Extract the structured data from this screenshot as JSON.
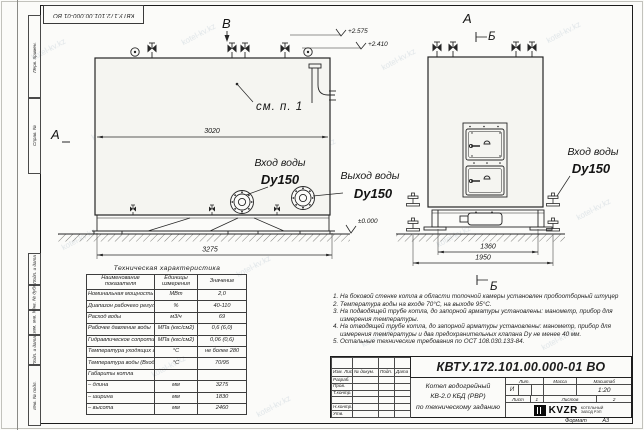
{
  "sheet": {
    "doc_number": "КВТУ.172.101.00.000-01 ВО"
  },
  "frame_fields": [
    "Перв. примен.",
    "Справ. №",
    "Подп. и дата",
    "Инв. № дубл.",
    "Взам. инв. №",
    "Подп. и дата",
    "Инв. № подл."
  ],
  "watermark": "kotel-kv.kz",
  "drawing": {
    "markers": {
      "view_b": "В",
      "section_a_left": "А",
      "section_a_right": "А",
      "section_b_top": "Б",
      "section_b_bottom": "Б"
    },
    "elevations": {
      "top_valve": "+2.575",
      "top_body": "+2.410",
      "ground": "±0.000"
    },
    "dimensions": {
      "body_length": "3020",
      "overall_length": "3275",
      "base_width": "1360",
      "overall_width": "1950"
    },
    "callout": "см. п. 1",
    "nozzles": {
      "inlet_side": {
        "line1": "Вход воды",
        "line2": "Dy150"
      },
      "outlet_side": {
        "line1": "Выход воды",
        "line2": "Dy150"
      },
      "inlet_front": {
        "line1": "Вход воды",
        "line2": "Dy150"
      }
    }
  },
  "spec_table": {
    "title": "Техническая характеристика",
    "headers": [
      "Наименование показателя",
      "Единицы измерения",
      "Значение"
    ],
    "rows": [
      [
        "Номинальная мощность",
        "МВт",
        "2,0"
      ],
      [
        "Диапазон рабочего регулирования",
        "%",
        "40-110"
      ],
      [
        "Расход воды",
        "м3/ч",
        "69"
      ],
      [
        "Рабочее давление воды",
        "МПа (кгс/см2)",
        "0,6 (6,0)"
      ],
      [
        "Гидравлическое сопротивление котла",
        "МПа (кгс/см2)",
        "0,06 (0,6)"
      ],
      [
        "Температура уходящих газов",
        "°С",
        "не более 280"
      ],
      [
        "Температура воды (Вход/Выход)",
        "°С",
        "70/95"
      ],
      [
        "Габариты котла",
        "",
        ""
      ],
      [
        "– длина",
        "мм",
        "3275"
      ],
      [
        "– ширина",
        "мм",
        "1830"
      ],
      [
        "– высота",
        "мм",
        "2460"
      ]
    ]
  },
  "notes": [
    "1. На боковой стенке котла в области топочной камеры установлен пробоотборный штуцер",
    "2. Температура воды на входе 70°С, на выходе 95°С.",
    "3. На подводящей трубе котла, до запорной арматуры установлены: манометр, прибор для измерения температуры.",
    "4. На отводящей трубе котла, до запорной арматуры установлены: манометр, прибор для измерения температуры и два предохранительных клапана Dу не менее 40 мм.",
    "5. Остальные технические требования по ОСТ 108.030.133-84."
  ],
  "title_block": {
    "doc_number": "КВТУ.172.101.00.000-01 ВО",
    "col_headers": [
      "Изм. Лист",
      "№ докум.",
      "Подп.",
      "Дата"
    ],
    "row_labels": [
      "Разраб.",
      "Пров.",
      "Т.контр.",
      "",
      "Н.контр.",
      "Утв."
    ],
    "title_lines": [
      "Котел водогрейный",
      "КВ-2.0 КБД (РВР)",
      "по техническому заданию"
    ],
    "lit_header": "Лит.",
    "mass_header": "Масса",
    "scale_header": "Масштаб",
    "lit_value": "И",
    "scale_value": "1:20",
    "sheet_label": "Лист",
    "sheet_value": "1",
    "sheets_label": "Листов",
    "sheets_value": "2",
    "logo_text": "KVZR",
    "company_line1": "КОТЕЛЬНЫЙ",
    "company_line2": "ЗАВОД РЭП",
    "format_label": "Формат",
    "format_value": "А3"
  }
}
